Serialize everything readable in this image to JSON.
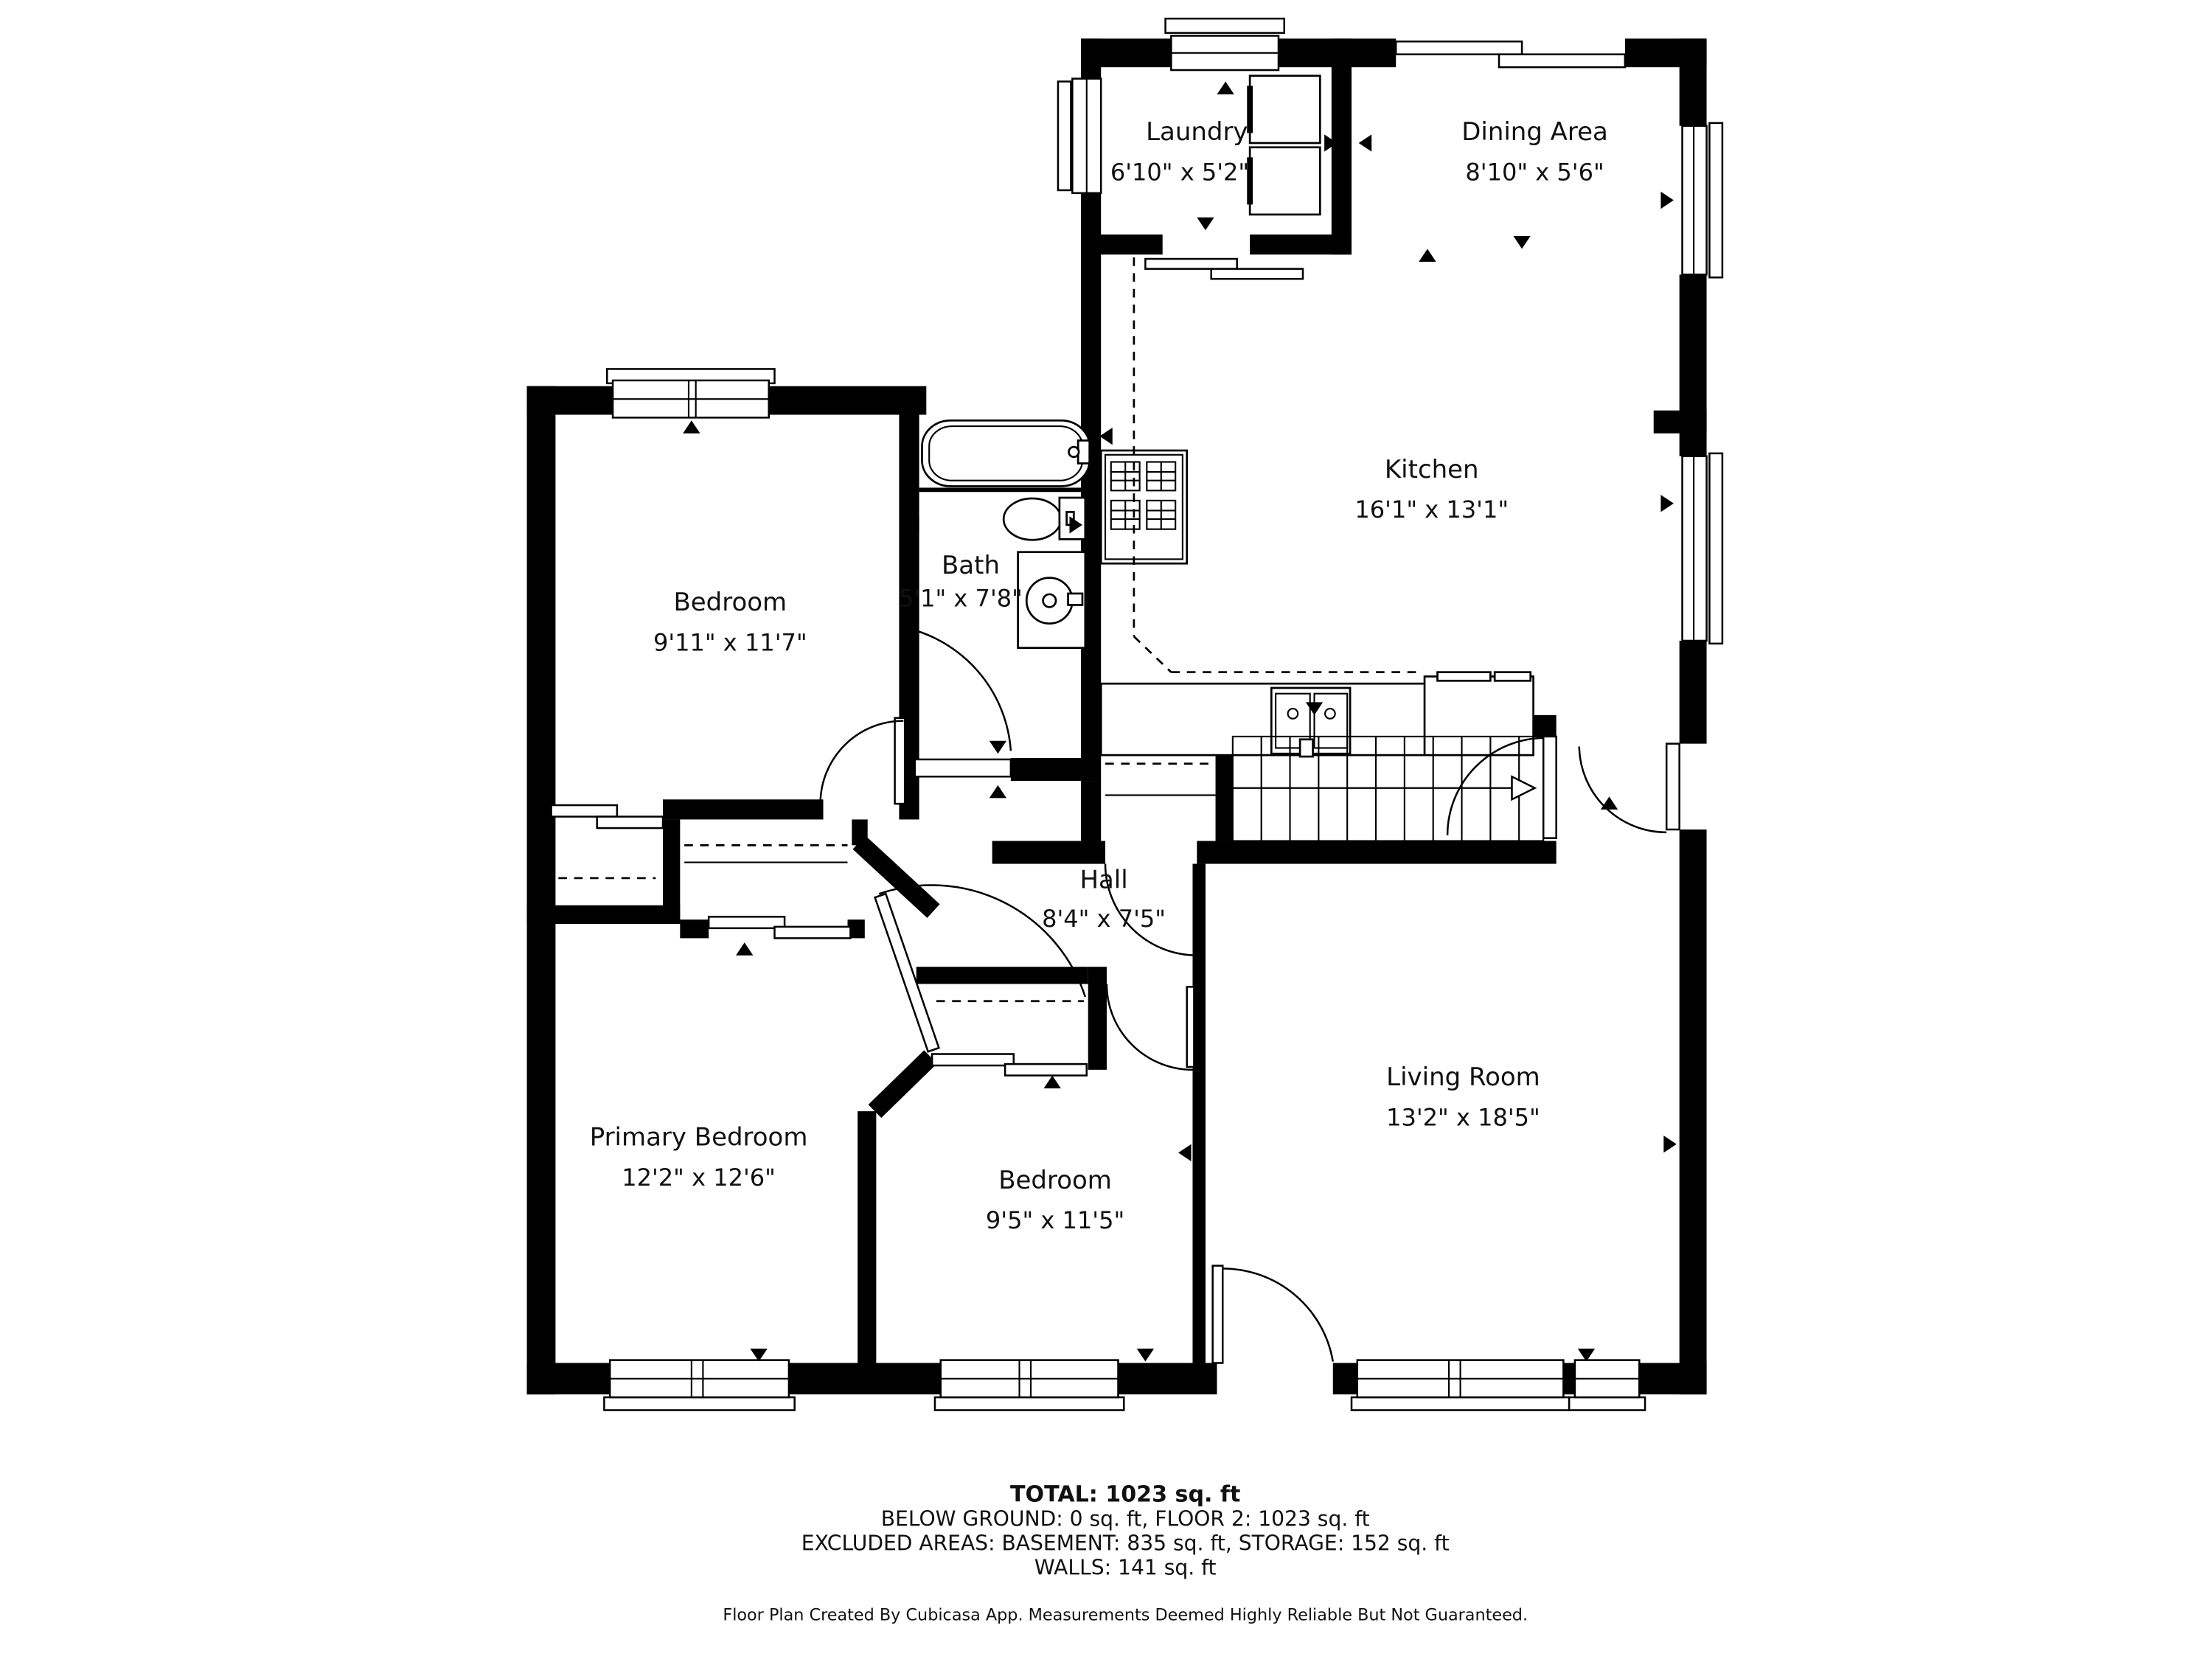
{
  "plan": {
    "rooms": [
      {
        "id": "laundry",
        "name": "Laundry",
        "dims": "6'10\" x 5'2\""
      },
      {
        "id": "dining",
        "name": "Dining Area",
        "dims": "8'10\" x 5'6\""
      },
      {
        "id": "kitchen",
        "name": "Kitchen",
        "dims": "16'1\" x 13'1\""
      },
      {
        "id": "bedroom-top",
        "name": "Bedroom",
        "dims": "9'11\" x 11'7\""
      },
      {
        "id": "bath",
        "name": "Bath",
        "dims": "5'1\" x 7'8\""
      },
      {
        "id": "hall",
        "name": "Hall",
        "dims": "8'4\" x 7'5\""
      },
      {
        "id": "primary-bedroom",
        "name": "Primary Bedroom",
        "dims": "12'2\" x 12'6\""
      },
      {
        "id": "bedroom-bottom",
        "name": "Bedroom",
        "dims": "9'5\" x 11'5\""
      },
      {
        "id": "living",
        "name": "Living Room",
        "dims": "13'2\" x 18'5\""
      }
    ],
    "summary": {
      "total": "TOTAL: 1023 sq. ft",
      "line2": "BELOW GROUND: 0 sq. ft, FLOOR 2: 1023 sq. ft",
      "line3": "EXCLUDED AREAS: BASEMENT: 835 sq. ft, STORAGE: 152 sq. ft",
      "line4": "WALLS: 141 sq. ft"
    },
    "footer": "Floor Plan Created By Cubicasa App. Measurements Deemed Highly Reliable But Not Guaranteed.",
    "colors": {
      "wall": "#000000",
      "background": "#ffffff",
      "text": "#111111"
    }
  }
}
